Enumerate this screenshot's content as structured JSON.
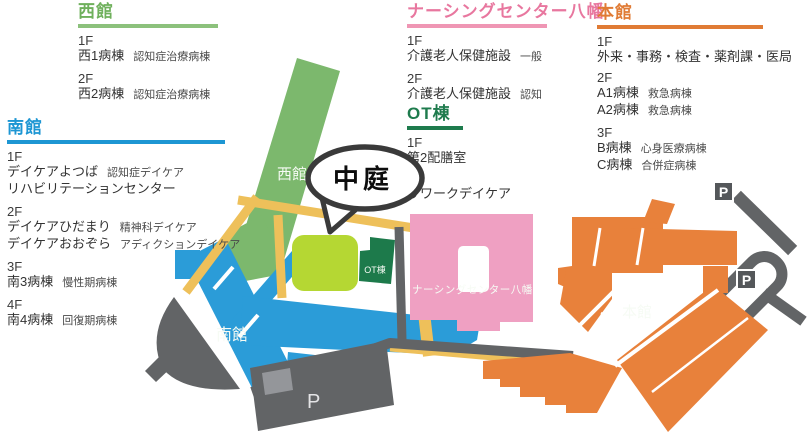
{
  "legend": {
    "west": {
      "title": "西館",
      "accent": "#6fb05c",
      "entries": [
        {
          "floor": "1F",
          "rows": [
            {
              "main": "西1病棟",
              "note": "認知症治療病棟"
            }
          ]
        },
        {
          "floor": "2F",
          "rows": [
            {
              "main": "西2病棟",
              "note": "認知症治療病棟"
            }
          ]
        }
      ]
    },
    "south": {
      "title": "南館",
      "accent": "#1d96d3",
      "entries": [
        {
          "floor": "1F",
          "rows": [
            {
              "main": "デイケアよつば",
              "note": "認知症デイケア"
            },
            {
              "main": "リハビリテーションセンター",
              "note": ""
            }
          ]
        },
        {
          "floor": "2F",
          "rows": [
            {
              "main": "デイケアひだまり",
              "note": "精神科デイケア"
            },
            {
              "main": "デイケアおおぞら",
              "note": "アディクションデイケア"
            }
          ]
        },
        {
          "floor": "3F",
          "rows": [
            {
              "main": "南3病棟",
              "note": "慢性期病棟"
            }
          ]
        },
        {
          "floor": "4F",
          "rows": [
            {
              "main": "南4病棟",
              "note": "回復期病棟"
            }
          ]
        }
      ]
    },
    "nursing": {
      "title": "ナーシングセンター八幡",
      "accent": "#e8779f",
      "entries": [
        {
          "floor": "1F",
          "rows": [
            {
              "main": "介護老人保健施設",
              "note": "一般"
            }
          ]
        },
        {
          "floor": "2F",
          "rows": [
            {
              "main": "介護老人保健施設",
              "note": "認知"
            }
          ]
        }
      ]
    },
    "ot": {
      "title": "OT棟",
      "accent": "#1e7b4d",
      "entries": [
        {
          "floor": "1F",
          "rows": [
            {
              "main": "第2配膳室",
              "note": ""
            }
          ]
        },
        {
          "floor": "2F",
          "rows": [
            {
              "main": "リワークデイケア",
              "note": ""
            }
          ]
        }
      ]
    },
    "main": {
      "title": "本館",
      "accent": "#e07b35",
      "entries": [
        {
          "floor": "1F",
          "rows": [
            {
              "main": "外来・事務・検査・薬剤課・医局",
              "note": ""
            }
          ]
        },
        {
          "floor": "2F",
          "rows": [
            {
              "main": "A1病棟",
              "note": "救急病棟"
            },
            {
              "main": "A2病棟",
              "note": "救急病棟"
            }
          ]
        },
        {
          "floor": "3F",
          "rows": [
            {
              "main": "B病棟",
              "note": "心身医療病棟"
            },
            {
              "main": "C病棟",
              "note": "合併症病棟"
            }
          ]
        }
      ]
    }
  },
  "map": {
    "labels": {
      "west": "西館",
      "south": "南館",
      "ot": "OT棟",
      "nursing": "ナーシングセンター八幡",
      "main": "本館",
      "courtyard": "中庭",
      "parking": "P"
    },
    "colors": {
      "west": "#7cb86d",
      "south": "#2b9cd8",
      "courtyard": "#b5d733",
      "ot": "#1d7a4b",
      "nursing": "#efa0c2",
      "main": "#e8813b",
      "road": "#626466",
      "road_light": "#94969a",
      "path": "#eec05a",
      "bubble_outline": "#3a3a3a"
    }
  }
}
